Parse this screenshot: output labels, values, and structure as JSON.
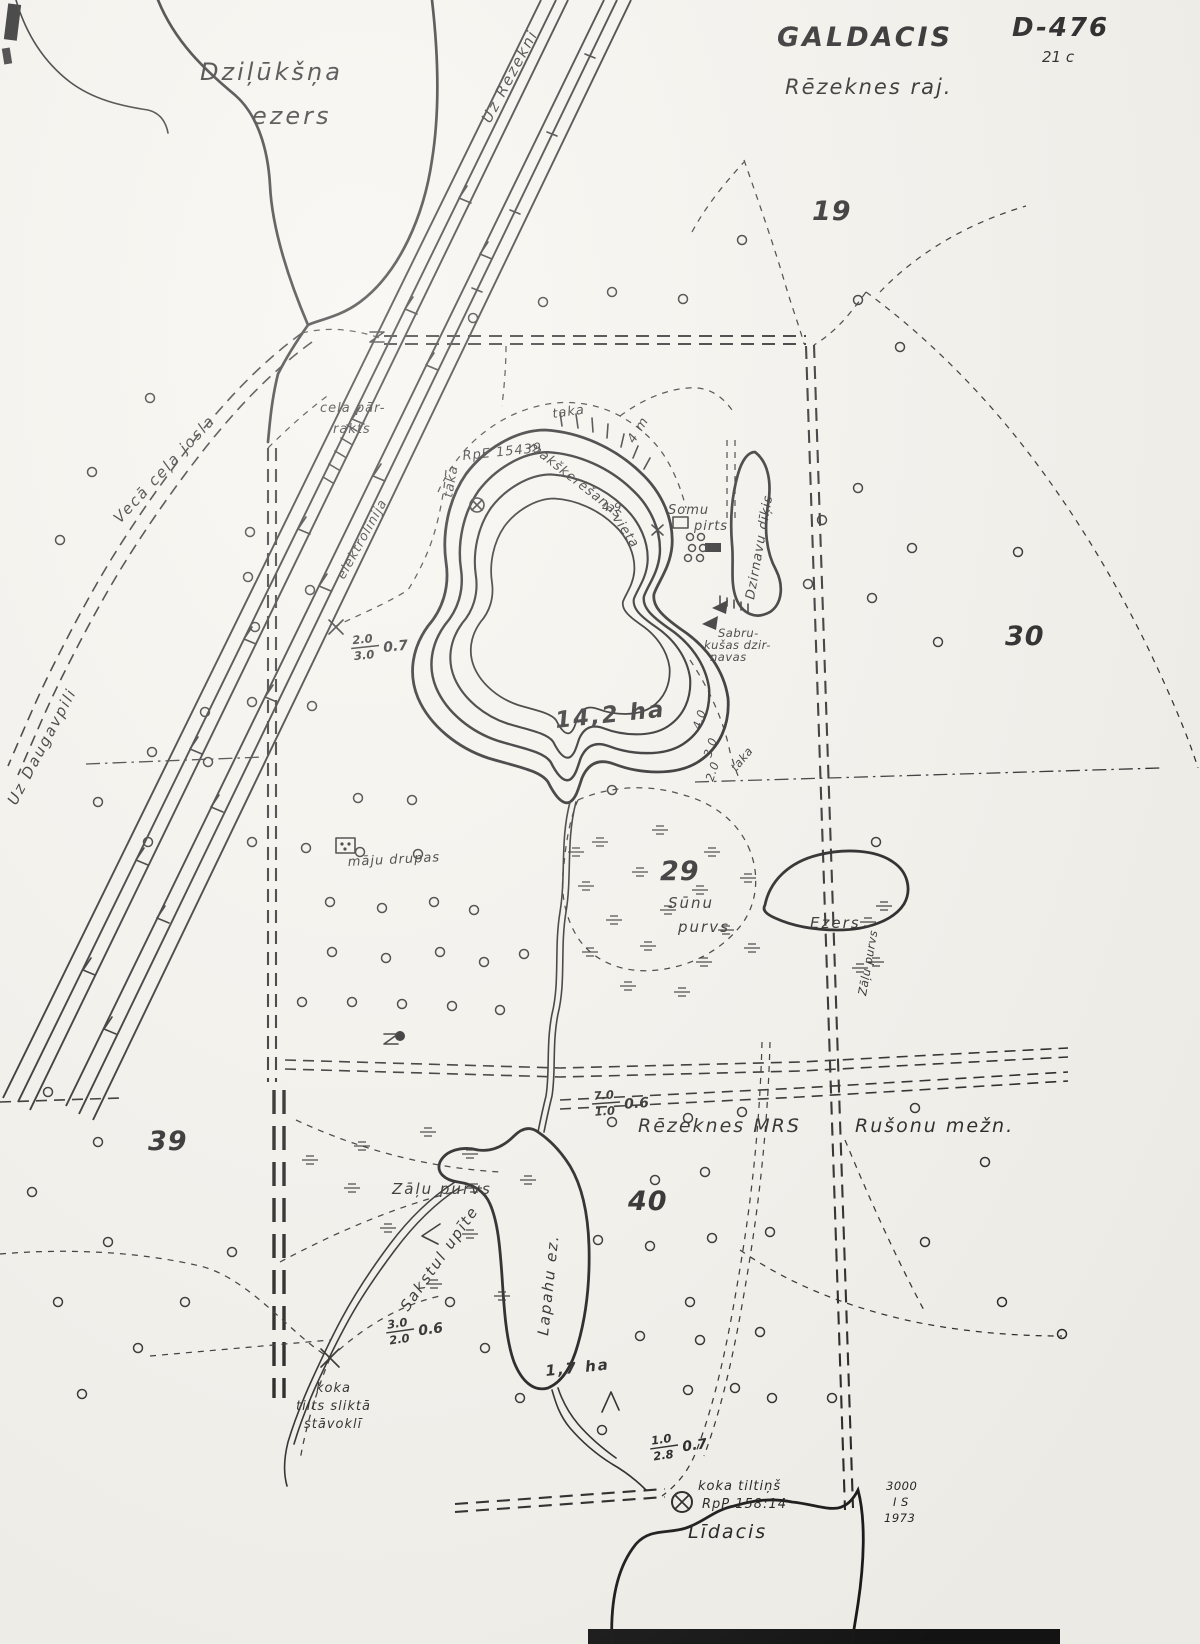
{
  "map": {
    "title": "GALDACIS",
    "subtitle": "Rēzeknes raj.",
    "code": "D-476",
    "code_sub": "21 c",
    "imprint": {
      "line1": "3000",
      "line2": "I S",
      "line3": "1973"
    },
    "lakes": {
      "dzilukssna_line1": "Dziļūkšņa",
      "dzilukssna_line2": "ezers",
      "main_area": "14,2 ha",
      "max_depth": "4,9",
      "small_lake": "Ezers",
      "lapahu": "Lapahu ez.",
      "lapahu_area": "1,7 ha",
      "lidacis": "Līdacis"
    },
    "directions": {
      "to_rezekne": "Uz Rēzekni",
      "to_daugavpils": "Uz Daugavpili"
    },
    "roads": {
      "old_road": "Vecā ceļa josla",
      "road_cut_line1": "ceļa pār-",
      "road_cut_line2": "rakts",
      "power_line": "elektrolīnija",
      "trail_label": "taka",
      "trail_width": "4 m"
    },
    "features": {
      "benchmark": "RpE 15439",
      "fishing_line1": "makšķerēšanas",
      "fishing_line2": "vieta",
      "sauna_line1": "Somu",
      "sauna_line2": "pirts",
      "mill_pond": "Dzirnavu dīķis",
      "ruined_mill_line1": "Sabru-",
      "ruined_mill_line2": "kušas dzir-",
      "ruined_mill_line3": "navas",
      "house_ruins": "māju drupas",
      "moss_bog_line1": "Sūnu",
      "moss_bog_line2": "purvs",
      "grass_bog": "Zāļu purvs",
      "grass_bog_right": "Zāļu purvs",
      "stream": "Sakstul upīte",
      "forestry1": "Rēzeknes MRS",
      "forestry2": "Rušonu mežn.",
      "bridge_bad_line1": "koka",
      "bridge_bad_line2": "tilts sliktā",
      "bridge_bad_line3": "stāvoklī",
      "bridge_small_line1": "koka tiltiņš",
      "bridge_small_line2": "RpP 158:14"
    },
    "compartments": {
      "c19": "19",
      "c29": "29",
      "c30": "30",
      "c39": "39",
      "c40": "40"
    },
    "contours": {
      "d2": "2.0",
      "d3": "3.0",
      "d4": "4.0"
    },
    "fractions": [
      {
        "top": "2.0",
        "bottom": "3.0",
        "side": "0.7"
      },
      {
        "top": "7.0",
        "bottom": "1.0",
        "side": "0.6"
      },
      {
        "top": "3.0",
        "bottom": "2.0",
        "side": "0.6"
      },
      {
        "top": "1.0",
        "bottom": "2.8",
        "side": "0.7"
      }
    ],
    "colors": {
      "ink": "#1e1e1e",
      "paper": "#f6f4ee"
    }
  }
}
